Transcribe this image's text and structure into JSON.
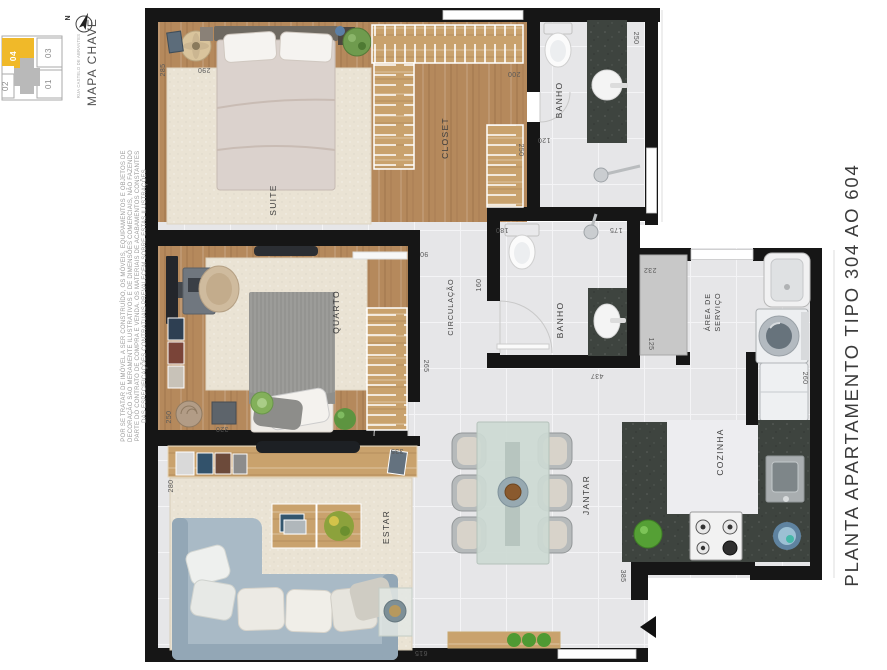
{
  "title": {
    "text": "PLANTA APARTAMENTO TIPO 304 AO 604"
  },
  "key_map": {
    "heading": "MAPA CHAVE",
    "street_label": "RUA CASTELO DE ABRANTES",
    "north_label": "N",
    "units": [
      {
        "label": "04",
        "highlighted": true
      },
      {
        "label": "03",
        "highlighted": false
      },
      {
        "label": "02",
        "highlighted": false
      },
      {
        "label": "01",
        "highlighted": false
      }
    ]
  },
  "disclaimer": {
    "lines": [
      "POR SE TRATAR DE IMÓVEL A SER CONSTRUÍDO, OS MÓVEIS, EQUIPAMENTOS E OBJETOS DE",
      "DECORAÇÃO SÃO MERAMENTE ILUSTRATIVOS E DE DIMENSÕES COMERCIAIS, NÃO FAZENDO",
      "PARTE DO CONTRATO DE COMPRA E VENDA. OS MATERIAIS DE ACABAMENTOS CONSTANTES",
      "DAS ESPECIFICAÇÕES CONTRATUAIS PREVALECEM SOBRE ESTAS ILUSTRAÇÕES"
    ]
  },
  "rooms": {
    "suite": "SUITE",
    "closet": "CLOSET",
    "banho_suite": "BANHO",
    "quarto": "QUARTO",
    "circulacao": "CIRCULAÇÃO",
    "banho_social": "BANHO",
    "area_servico_l1": "ÁREA DE",
    "area_servico_l2": "SERVIÇO",
    "cozinha": "COZINHA",
    "jantar": "JANTAR",
    "estar": "ESTAR"
  },
  "dims": {
    "d285": "285",
    "d290": "290",
    "d200": "200",
    "d250_banho": "250",
    "d120": "120",
    "d250_closet": "250",
    "d180": "180",
    "d175": "175",
    "d90": "90",
    "d160": "160",
    "d265": "265",
    "d437": "437",
    "d232": "232",
    "d125": "125",
    "d250_quarto": "250",
    "d320": "320",
    "d335": "335",
    "d280": "280",
    "d260": "260",
    "d385": "385",
    "d615": "615"
  },
  "colors": {
    "unit_highlight": "#f0b929",
    "wall": "#161616",
    "wood": "#b5895c",
    "wood_light": "#c9a26d",
    "tile": "#e6e6e8",
    "tile_light": "#ededf0",
    "carpet": "#eae3d4",
    "counter_dark": "#3e443f",
    "sofa": "#a9bac6",
    "sofa_back": "#93a7b6",
    "plant_green": "#55a035",
    "text_dark": "#3d3d3d",
    "dim_text": "#585858",
    "title_text": "#3b3b3b"
  }
}
